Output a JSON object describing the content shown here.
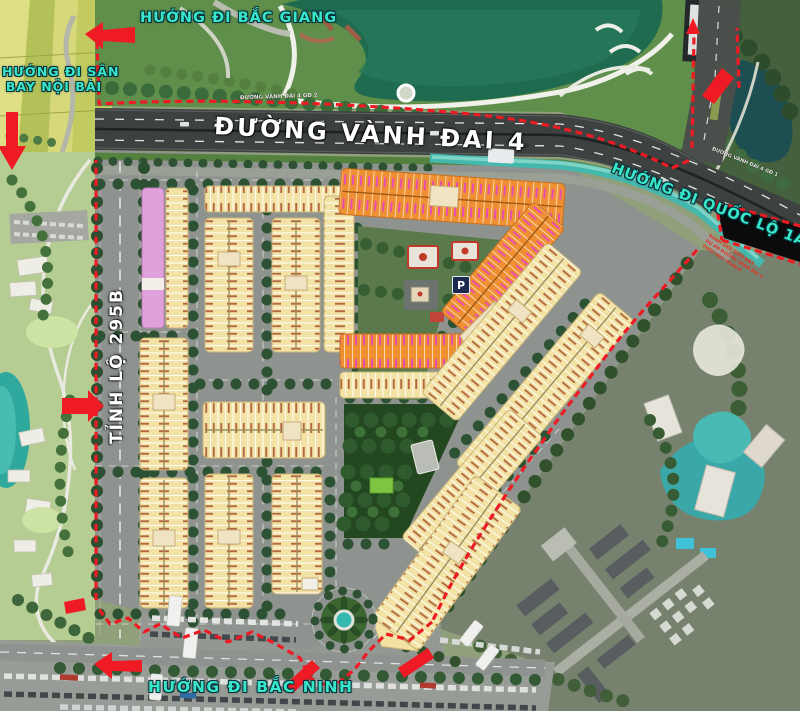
{
  "map": {
    "labels": {
      "bac_giang": "HƯỚNG ĐI BẮC GIANG",
      "san_bay_line1": "HƯỚNG ĐI SÂN",
      "san_bay_line2": "BAY NỘI BÀI",
      "vanh_dai_4": "ĐƯỜNG VÀNH ĐAI 4",
      "vanh_dai_4_gd2": "ĐƯỜNG VÀNH ĐAI 4 GĐ 2",
      "vanh_dai_4_gd1": "ĐƯỜNG VÀNH ĐAI 4 GĐ 1",
      "quoc_lo_1a": "HƯỚNG ĐI QUỐC LỘ 1A",
      "tinh_lo_295b": "TỈNH LỘ 295B",
      "bac_ninh": "HƯỚNG ĐI BẮC NINH",
      "parking_badge": "P",
      "boundary_notes": [
        "RANH GIỚI GIAO ĐẤT",
        "DỰ ÁN ĐƯỜNG VÀNH ĐAI 4",
        "THEO QUY HOẠCH"
      ]
    },
    "colors": {
      "boundary_red": "#ee1b24",
      "direction_label_teal": "#38e6c9",
      "highway_dark": "#3d4241",
      "lot_yellow": "#f2e3a5",
      "lot_orange": "#ee8f33",
      "block_pink": "#dfa0dc",
      "canal_teal": "#45b8ae",
      "park_green": "#23481f",
      "lake_green": "#1e6b50"
    }
  }
}
